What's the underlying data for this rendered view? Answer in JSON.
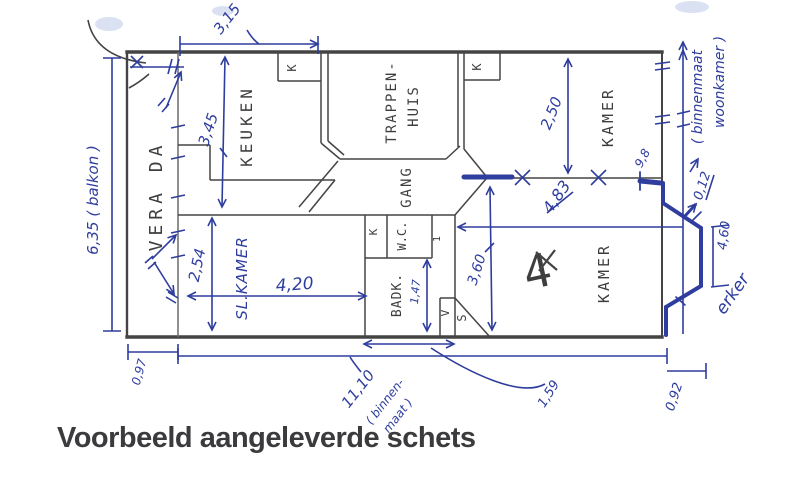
{
  "title": "Voorbeeld aangeleverde schets",
  "colors": {
    "pen_blue": "#2e3d9e",
    "pencil_dark": "#3e3e3e",
    "highlight_blue": "#bcc9ea"
  },
  "rooms": {
    "veranda": "VERA DA",
    "keuken": "KEUKEN",
    "trappenhuis1": "TRAPPEN-",
    "trappenhuis2": "HUIS",
    "gang": "GANG",
    "kamer_top": "KAMER",
    "kamer_bottom": "KAMER",
    "slaapkamer": "SL.KAMER",
    "badkamer": "BADK.",
    "wc": "W.C.",
    "kast_a": "K",
    "kast_b": "K",
    "kast_c": "K",
    "v_mark": "V",
    "s_mark": "S",
    "one_mark": "1",
    "four_mark": "4"
  },
  "dims": {
    "top_width": "3,15",
    "keuken_depth": "3,45",
    "balkon_length": "6,35 ( balkon )",
    "slk_width": "4,20",
    "slk_height": "2,54",
    "veranda_width": "0,97",
    "total_inner_width": "11,10",
    "total_note1": "( binnen-",
    "total_note2": "maat )",
    "seg_159": "1,59",
    "kamer_top_depth": "2,50",
    "kamer_bottom_width": "4,83",
    "kamer_bottom_depth": "3,60",
    "badk_depth": "1,47",
    "door_width": "9,8",
    "wall_offset": "0,12",
    "erker_face": "4,60",
    "erker_depth": "0,92",
    "erker_label": "erker",
    "binnenmaat1": "( binnenmaat",
    "binnenmaat2": "woonkamer )"
  }
}
